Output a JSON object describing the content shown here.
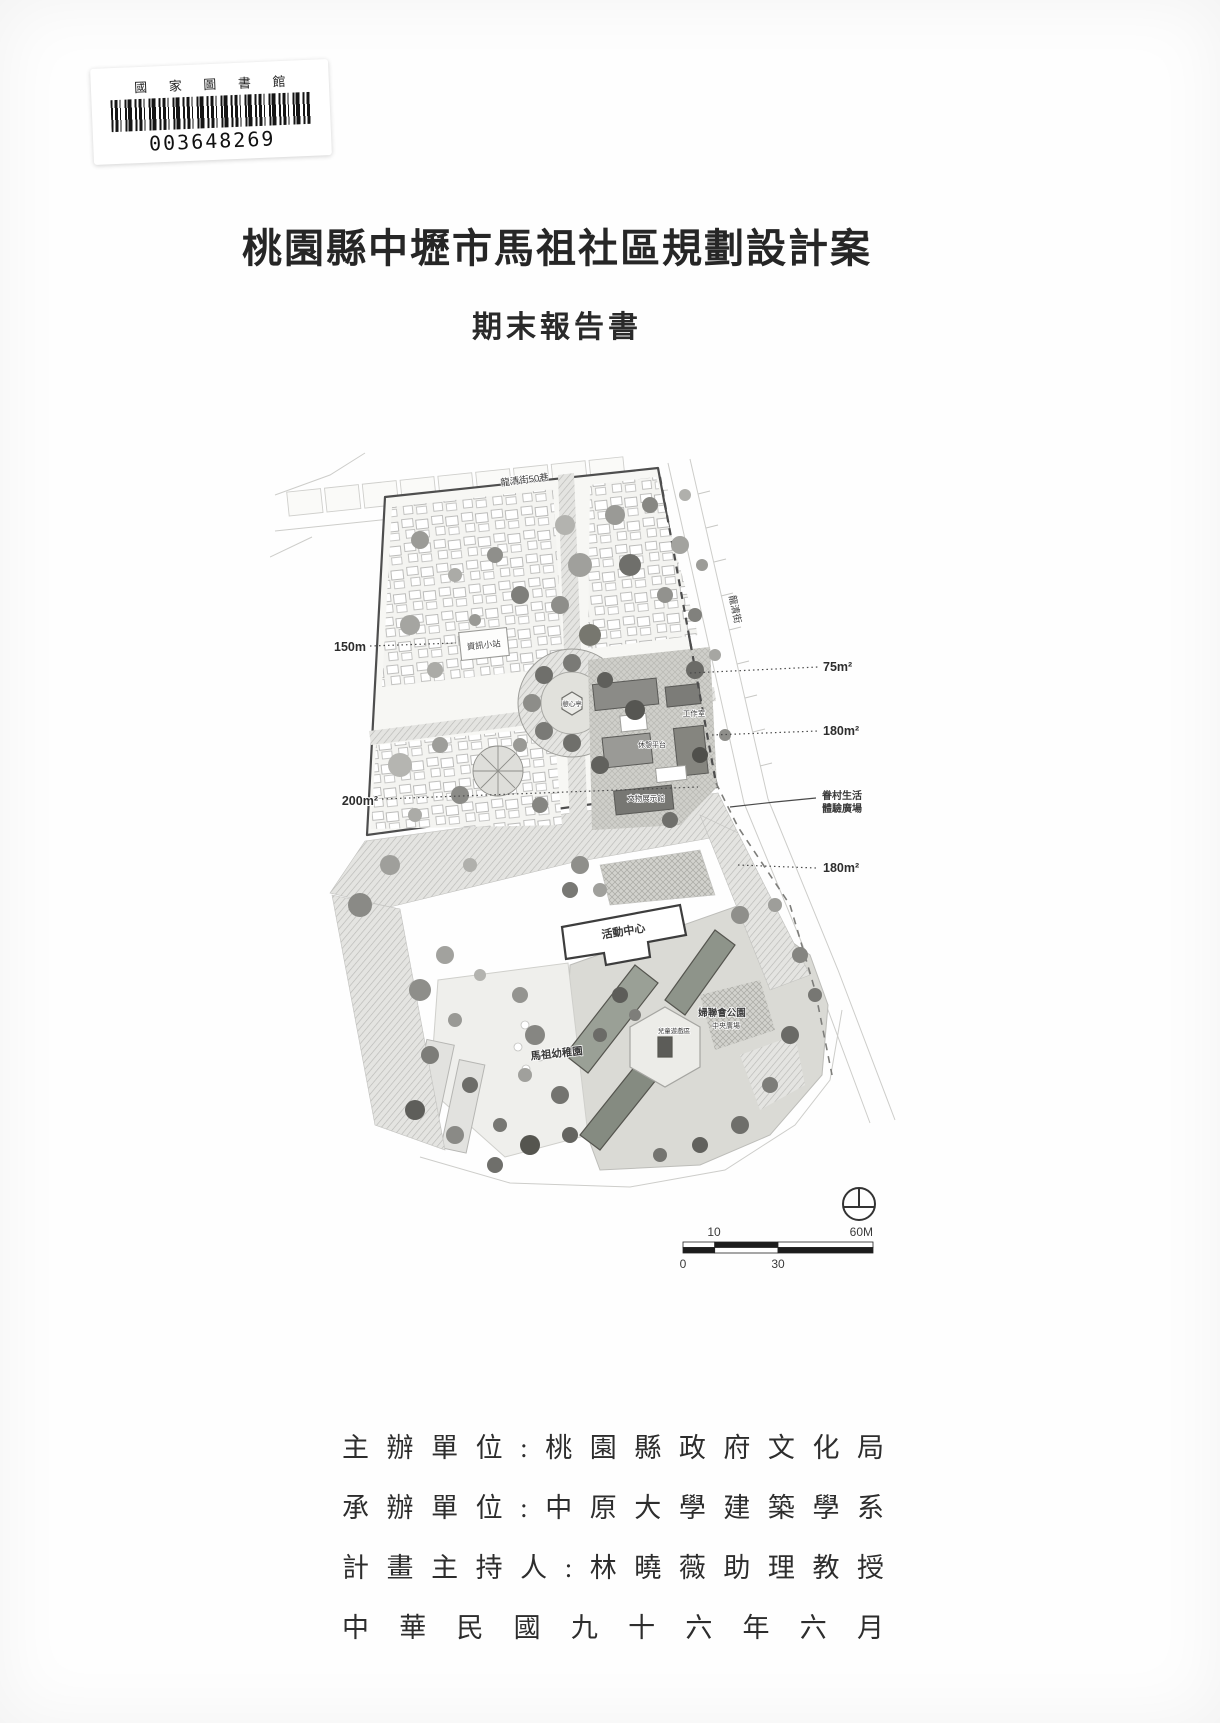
{
  "library_stamp": {
    "institution": "國 家 圖 書 館",
    "barcode_number": "003648269"
  },
  "cover": {
    "title": "桃園縣中壢市馬祖社區規劃設計案",
    "subtitle": "期末報告書"
  },
  "site_plan": {
    "streets": {
      "top": "龍清街50巷",
      "right": "龍清街"
    },
    "dimension_labels": {
      "left_150": "150m",
      "left_200": "200m²",
      "right_75": "75m²",
      "right_180_a": "180m²",
      "right_180_b": "180m²"
    },
    "place_labels": {
      "info_station": "資訊小站",
      "pavilion": "憩心亭",
      "workshop": "工作室",
      "rest_platform": "休憩平台",
      "exhibit_hall": "文物展示館",
      "village_plaza_line1": "眷村生活",
      "village_plaza_line2": "體驗廣場",
      "activity_center": "活動中心",
      "kindergarten": "馬祖幼稚園",
      "park": "婦聯會公園",
      "central_plaza": "中央廣場",
      "play_area": "兒童遊戲區"
    },
    "scale_bar": {
      "tick_10": "10",
      "tick_60": "60M",
      "tick_0": "0",
      "tick_30": "30"
    }
  },
  "footer": {
    "organizer_line": "主辦單位:桃園縣政府文化局",
    "executor_line": "承辦單位:中原大學建築學系",
    "director_line": "計畫主持人:林曉薇助理教授",
    "date_line": "中華民國九十六年六月"
  }
}
